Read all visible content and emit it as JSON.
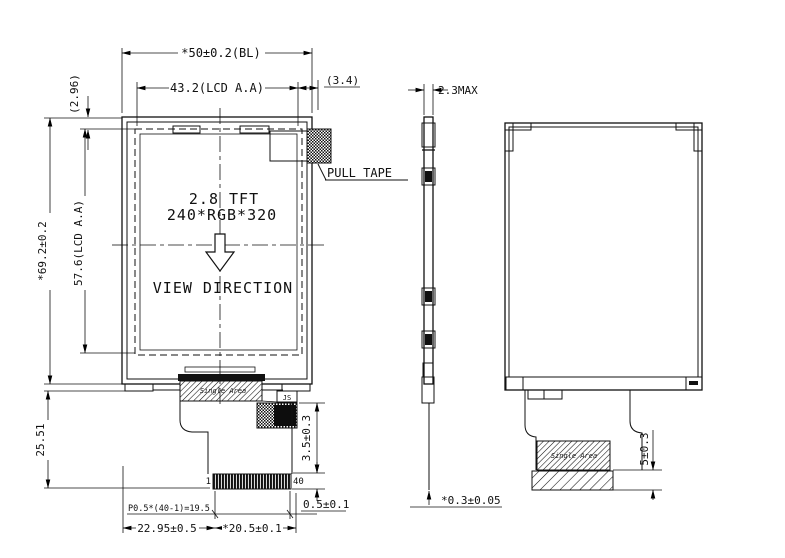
{
  "front": {
    "title_line1": "2.8 TFT",
    "title_line2": "240*RGB*320",
    "view_direction": "VIEW DIRECTION",
    "pull_tape": "PULL TAPE",
    "pin_first": "1",
    "pin_last": "40",
    "bonding_label": "Single Area",
    "ic_label": "JS"
  },
  "rear": {
    "stiffener_label": "Single Area"
  },
  "dims": {
    "overall_width": "*50±0.2(BL)",
    "aa_width": "43.2(LCD A.A)",
    "right_margin": "(3.4)",
    "top_margin": "(2.96)",
    "overall_height": "*69.2±0.2",
    "aa_height": "57.6(LCD A.A)",
    "fpc_length": "25.51",
    "connector_offset": "3.5±0.3",
    "connector_stub": "0.5±0.1",
    "pin_pitch": "P0.5*(40-1)=19.5",
    "fpc_width": "22.95±0.5",
    "connector_width": "*20.5±0.1",
    "thickness": "2.3MAX",
    "fpc_thickness": "*0.3±0.05",
    "stiffener_height": "5±0.3"
  }
}
